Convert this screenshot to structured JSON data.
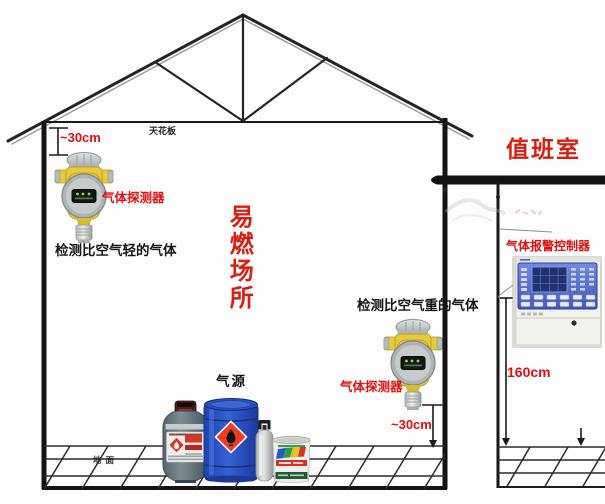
{
  "diagram": {
    "type": "gas-detector-installation-diagram",
    "labels": {
      "ceiling": "天花板",
      "ground": "地面",
      "flammable_area": "易燃场所",
      "duty_room": "值班室",
      "gas_detector_1": "气体探测器",
      "gas_detector_2": "气体探测器",
      "detect_lighter_gas": "检测比空气轻的气体",
      "detect_heavier_gas": "检测比空气重的气体",
      "gas_source": "气源",
      "gas_alarm_controller": "气体报警控制器",
      "clearance_ceiling": "~30cm",
      "clearance_floor": "~30cm",
      "controller_mount_height": "160cm"
    },
    "colors": {
      "label_red": "#e01010",
      "title_red": "#d81e10",
      "text_black": "#161616",
      "line_black": "#1c1c1c",
      "detector_yellow": "#e7c93c",
      "controller_panel_blue": "#5570cc",
      "drum_blue": "#2853c6",
      "hazard_diamond_red": "#ef3b20"
    },
    "icons": {
      "gas-detector-icon": "yellow explosion-proof detector with silver sensor head",
      "gas-alarm-controller-icon": "white wall box with blue screen panel",
      "lpg-cylinder-icon": "grey gas cylinder with red hazard label",
      "chemical-drum-icon": "blue drum with red flammable diamond",
      "gas-bottle-icon": "small grey bottle with black valve handle",
      "paint-bucket-icon": "pail with striped label",
      "flammable-diamond-icon": "◆ red diamond with black flame",
      "down-arrow-icon": "▼",
      "measure-bar-icon": "⊥ dimension line with end caps"
    }
  }
}
